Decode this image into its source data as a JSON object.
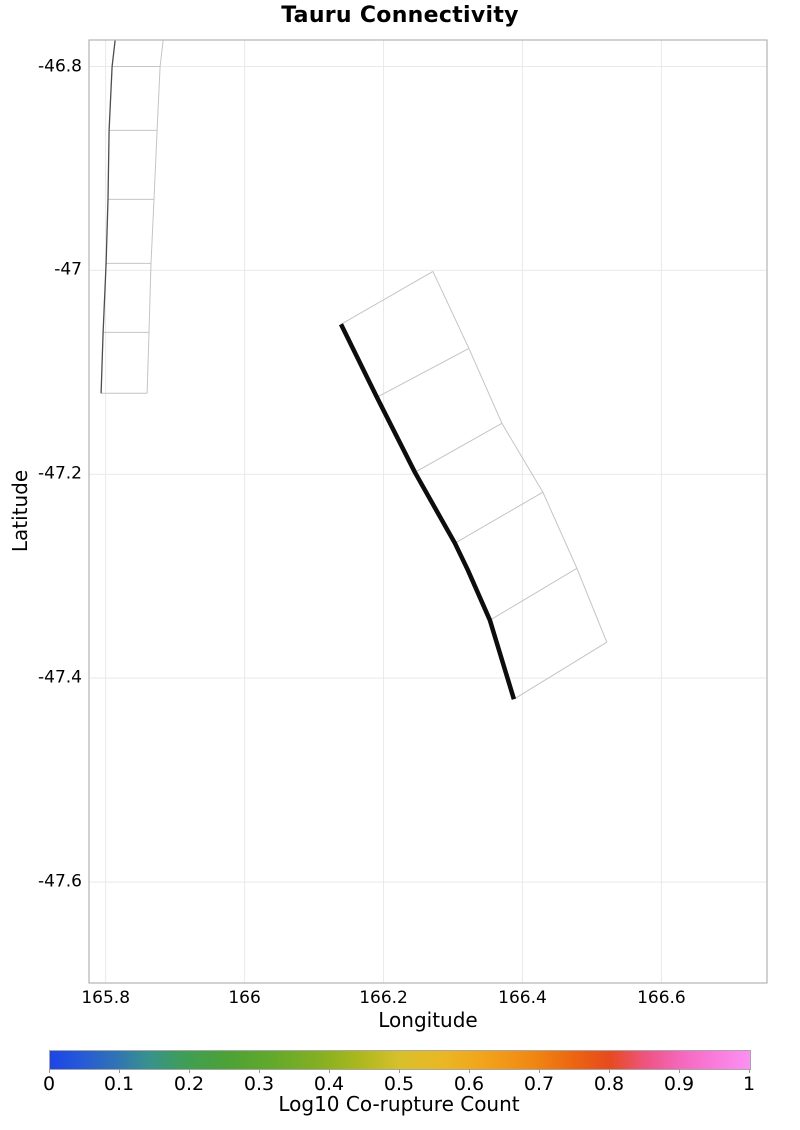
{
  "title": "Tauru Connectivity",
  "colors": {
    "background": "#ffffff",
    "grid": "#e9e9e9",
    "spine": "#b3b3b3",
    "text": "#000000"
  },
  "chart_data": {
    "type": "line",
    "subtype": "fault-subsection-map",
    "title": "Tauru Connectivity",
    "xlabel": "Longitude",
    "ylabel": "Latitude",
    "xlim": [
      165.776,
      166.752
    ],
    "ylim": [
      -47.699,
      -46.774
    ],
    "grid": true,
    "legend": "none",
    "x_ticks": [
      {
        "value": 165.8,
        "label": "165.8"
      },
      {
        "value": 166.0,
        "label": "166"
      },
      {
        "value": 166.2,
        "label": "166.2"
      },
      {
        "value": 166.4,
        "label": "166.4"
      },
      {
        "value": 166.6,
        "label": "166.6"
      }
    ],
    "y_ticks": [
      {
        "value": -46.8,
        "label": "-46.8"
      },
      {
        "value": -47.0,
        "label": "-47"
      },
      {
        "value": -47.2,
        "label": "-47.2"
      },
      {
        "value": -47.4,
        "label": "-47.4"
      },
      {
        "value": -47.6,
        "label": "-47.6"
      }
    ],
    "faults": [
      {
        "name": "northwest-neighbor-fault",
        "trace_color": "#4d4d4d",
        "trace_width": 1.3,
        "outline_color": "#c4c4c4",
        "outline_width": 1,
        "trace": [
          [
            165.8135,
            -46.7745
          ],
          [
            165.8092,
            -46.8
          ],
          [
            165.8049,
            -46.8627
          ],
          [
            165.8034,
            -46.9304
          ],
          [
            165.8006,
            -46.9931
          ],
          [
            165.7963,
            -47.0608
          ],
          [
            165.7934,
            -47.1206
          ]
        ],
        "outline_segments": [
          [
            [
              165.8826,
              -46.7745
            ],
            [
              165.8783,
              -46.8
            ],
            [
              165.874,
              -46.8627
            ],
            [
              165.8696,
              -46.9304
            ],
            [
              165.8653,
              -46.9931
            ],
            [
              165.8624,
              -47.0608
            ],
            [
              165.8596,
              -47.1206
            ]
          ],
          [
            [
              165.8092,
              -46.8
            ],
            [
              165.8783,
              -46.8
            ]
          ],
          [
            [
              165.8049,
              -46.8627
            ],
            [
              165.874,
              -46.8627
            ]
          ],
          [
            [
              165.8034,
              -46.9304
            ],
            [
              165.8696,
              -46.9304
            ]
          ],
          [
            [
              165.8006,
              -46.9931
            ],
            [
              165.8653,
              -46.9931
            ]
          ],
          [
            [
              165.7963,
              -47.0608
            ],
            [
              165.8624,
              -47.0608
            ]
          ],
          [
            [
              165.7934,
              -47.1206
            ],
            [
              165.8596,
              -47.1206
            ]
          ]
        ]
      },
      {
        "name": "tauru-fault",
        "trace_color": "#0d0d0d",
        "trace_width": 4.5,
        "outline_color": "#c4c4c4",
        "outline_width": 1,
        "trace": [
          [
            166.1387,
            -47.0529
          ],
          [
            166.1905,
            -47.1245
          ],
          [
            166.2452,
            -47.198
          ],
          [
            166.3027,
            -47.2676
          ],
          [
            166.3214,
            -47.2941
          ],
          [
            166.3531,
            -47.3431
          ],
          [
            166.3876,
            -47.4206
          ]
        ],
        "outline_segments": [
          [
            [
              166.1387,
              -47.0529
            ],
            [
              166.2711,
              -47.001
            ]
          ],
          [
            [
              166.2711,
              -47.001
            ],
            [
              166.3229,
              -47.0765
            ],
            [
              166.3704,
              -47.15
            ],
            [
              166.4294,
              -47.2176
            ],
            [
              166.4783,
              -47.2922
            ],
            [
              166.5214,
              -47.3647
            ]
          ],
          [
            [
              166.1905,
              -47.1245
            ],
            [
              166.3229,
              -47.0765
            ]
          ],
          [
            [
              166.2452,
              -47.198
            ],
            [
              166.3704,
              -47.15
            ]
          ],
          [
            [
              166.3027,
              -47.2676
            ],
            [
              166.4294,
              -47.2176
            ]
          ],
          [
            [
              166.3531,
              -47.3431
            ],
            [
              166.4783,
              -47.2922
            ]
          ],
          [
            [
              166.3876,
              -47.4206
            ],
            [
              166.5214,
              -47.3647
            ]
          ]
        ]
      }
    ],
    "colorbar": {
      "label": "Log10 Co-rupture Count",
      "min": 0,
      "max": 1,
      "orientation": "horizontal",
      "ticks": [
        {
          "value": 0.0,
          "label": "0"
        },
        {
          "value": 0.1,
          "label": "0.1"
        },
        {
          "value": 0.2,
          "label": "0.2"
        },
        {
          "value": 0.3,
          "label": "0.3"
        },
        {
          "value": 0.4,
          "label": "0.4"
        },
        {
          "value": 0.5,
          "label": "0.5"
        },
        {
          "value": 0.6,
          "label": "0.6"
        },
        {
          "value": 0.7,
          "label": "0.7"
        },
        {
          "value": 0.8,
          "label": "0.8"
        },
        {
          "value": 0.9,
          "label": "0.9"
        },
        {
          "value": 1.0,
          "label": "1"
        }
      ],
      "gradient_stops": [
        {
          "pos": 0.0,
          "color": "#1d45e6"
        },
        {
          "pos": 0.04,
          "color": "#2458d8"
        },
        {
          "pos": 0.09,
          "color": "#2f71b7"
        },
        {
          "pos": 0.14,
          "color": "#37928c"
        },
        {
          "pos": 0.19,
          "color": "#3f9e57"
        },
        {
          "pos": 0.25,
          "color": "#4ba236"
        },
        {
          "pos": 0.31,
          "color": "#60a82c"
        },
        {
          "pos": 0.38,
          "color": "#82af22"
        },
        {
          "pos": 0.44,
          "color": "#abb71d"
        },
        {
          "pos": 0.5,
          "color": "#d8c02b"
        },
        {
          "pos": 0.56,
          "color": "#eab724"
        },
        {
          "pos": 0.62,
          "color": "#f2a31b"
        },
        {
          "pos": 0.69,
          "color": "#f18712"
        },
        {
          "pos": 0.75,
          "color": "#ec6412"
        },
        {
          "pos": 0.8,
          "color": "#e74a1e"
        },
        {
          "pos": 0.85,
          "color": "#ee5480"
        },
        {
          "pos": 0.9,
          "color": "#f467bc"
        },
        {
          "pos": 0.95,
          "color": "#f97bdc"
        },
        {
          "pos": 1.0,
          "color": "#fc90f4"
        }
      ]
    }
  }
}
